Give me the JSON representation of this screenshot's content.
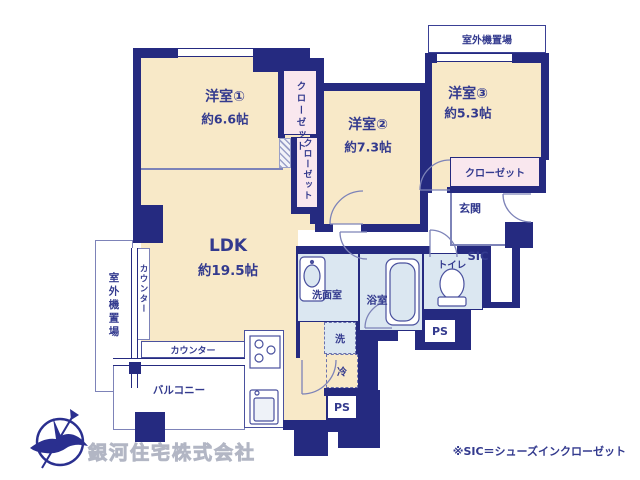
{
  "rooms": {
    "western1": {
      "name": "洋室①",
      "size": "約6.6帖"
    },
    "western2": {
      "name": "洋室②",
      "size": "約7.3帖"
    },
    "western3": {
      "name": "洋室③",
      "size": "約5.3帖"
    },
    "ldk": {
      "name": "LDK",
      "size": "約19.5帖"
    }
  },
  "labels": {
    "closet_upper": "クローゼット",
    "closet_lower": "クローゼット",
    "closet_west3": "クローゼット",
    "outdoor_top": "室外機置場",
    "outdoor_left": "室外機置場",
    "entrance": "玄関",
    "sic": "SIC",
    "toilet": "トイレ",
    "bath": "浴室",
    "washroom": "洗面室",
    "washer": "洗",
    "fridge": "冷",
    "ps_upper": "PS",
    "ps_lower": "PS",
    "balcony": "バルコニー",
    "counter_left": "カウンター",
    "counter_bottom": "カウンター"
  },
  "footer": {
    "company": "銀河住宅株式会社",
    "note": "※SIC＝シューズインクローゼット"
  },
  "colors": {
    "wall": "#252a80",
    "room_cream": "#f8e9c8",
    "closet_pink": "#f9e7ee",
    "wet_blue": "#dbe7f1",
    "text": "#333a8e",
    "thin_line": "#7d83b8",
    "logo": "#2a2f8f"
  }
}
